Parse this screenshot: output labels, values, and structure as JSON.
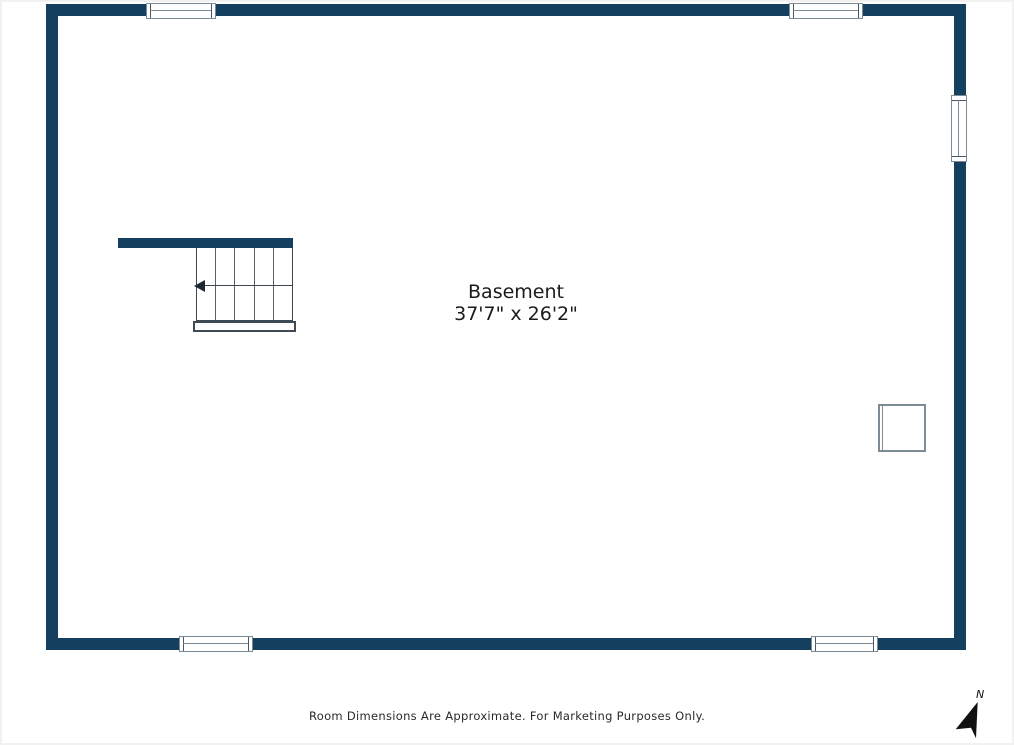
{
  "floorplan": {
    "room": {
      "label": "Basement",
      "dimensions": "37'7\" x 26'2\""
    },
    "disclaimer": "Room Dimensions Are Approximate. For Marketing Purposes Only.",
    "compass": {
      "label": "N"
    },
    "stairs": {
      "treads": 5,
      "arrow_direction": "left"
    },
    "windows": [
      {
        "name": "top-left-window",
        "wall": "top"
      },
      {
        "name": "top-right-window",
        "wall": "top"
      },
      {
        "name": "right-window",
        "wall": "right"
      },
      {
        "name": "bottom-left-window",
        "wall": "bottom"
      },
      {
        "name": "bottom-right-window",
        "wall": "bottom"
      }
    ],
    "colors": {
      "wall": "#143f5e",
      "stair_line": "#46525c",
      "window_border": "#7d8b95",
      "text": "#1b1b1b"
    }
  }
}
